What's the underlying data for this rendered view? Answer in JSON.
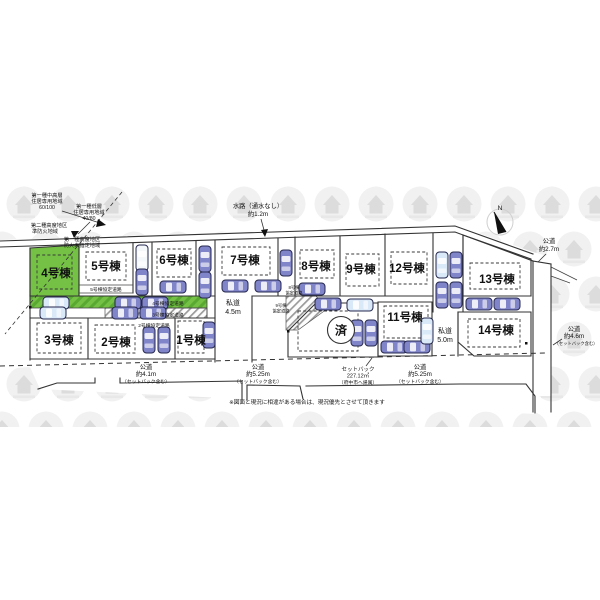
{
  "colors": {
    "lot_highlight": "#74c145",
    "stripe_dark": "#58a832",
    "car_dark": "#8084c9",
    "car_light": "#d9e9f7",
    "car_white": "#f4f8fb"
  },
  "compass": {
    "north": "N"
  },
  "waterway": {
    "l1": "水路（通水なし）",
    "l2": "約1.2m"
  },
  "zoning": {
    "a1_l1": "第一種中高層",
    "a1_l2": "住居専用地域",
    "a1_l3": "60/100",
    "a2_l1": "第一種低層",
    "a2_l2": "住居専用地域",
    "a2_l3": "40/80",
    "a3_l1": "第二種高度地区",
    "a3_l2": "準防火地域",
    "a4_l1": "第一種高度地区",
    "a4_l2": "防火未指定地域"
  },
  "lots": {
    "lot1": "1号棟",
    "lot2": "2号棟",
    "lot3": "3号棟",
    "lot4": "4号棟",
    "lot5": "5号棟",
    "lot6": "6号棟",
    "lot7": "7号棟",
    "lot8": "8号棟",
    "lot9": "9号棟",
    "lot11": "11号棟",
    "lot12": "12号棟",
    "lot13": "13号棟",
    "lot14": "14号棟",
    "sold": "済"
  },
  "agreement_roads": {
    "a5": "5号棟協定道路",
    "a4": "4号棟協定道路",
    "a3": "3号棟協定道路",
    "a2": "2号棟協定道路",
    "a8_1": "8号棟",
    "a8_2": "協定道路",
    "a9_1": "9号棟",
    "a9_2": "協定道路"
  },
  "roads": {
    "private45_1": "私道",
    "private45_2": "4.5m",
    "private50_1": "私道",
    "private50_2": "5.0m",
    "public41_1": "公道",
    "public41_2": "約4.1m",
    "public41_3": "（セットバック含む）",
    "public525l_1": "公道",
    "public525l_2": "約5.25m",
    "public525l_3": "（セットバック含む）",
    "setback_1": "セットバック",
    "setback_2": "227.12㎡",
    "setback_3": "（府中市へ帰属）",
    "public525r_1": "公道",
    "public525r_2": "約5.25m",
    "public525r_3": "（セットバック含む）",
    "public46_1": "公道",
    "public46_2": "約4.6m",
    "public46_3": "（セットバック含む）",
    "public27_1": "公道",
    "public27_2": "約2.7m"
  },
  "note": "※図面と現況に相違がある場合は、現況優先とさせて頂きます"
}
